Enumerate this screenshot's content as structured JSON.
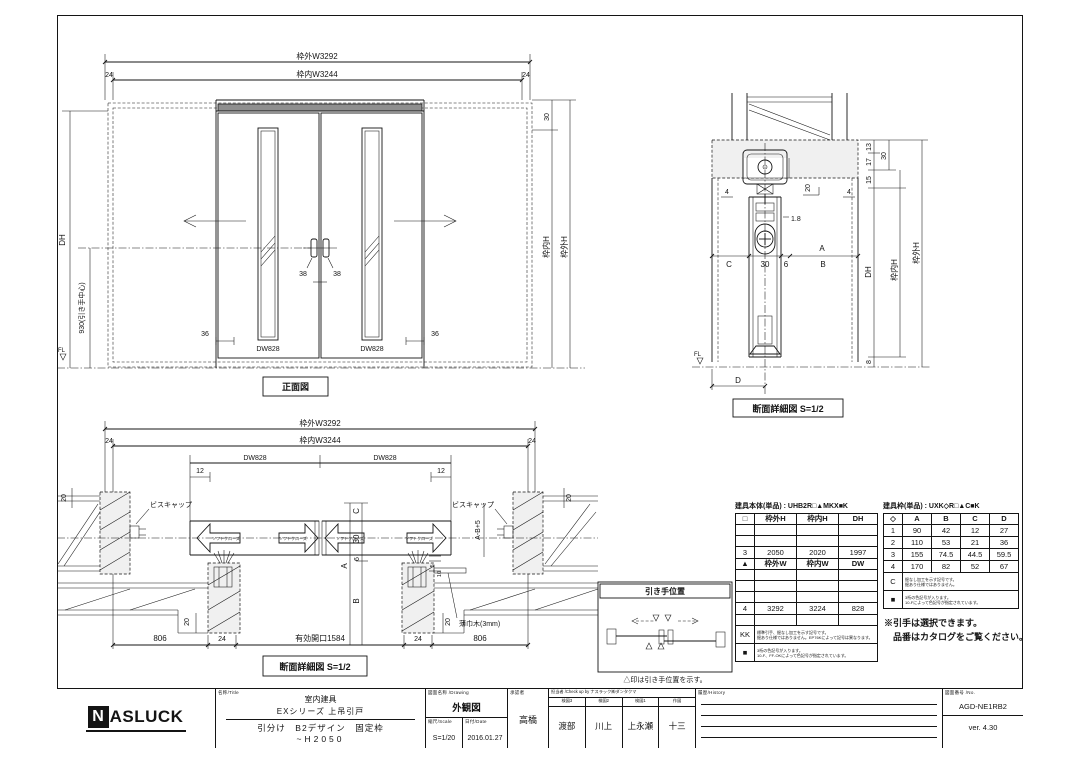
{
  "page": {
    "bg": "#ffffff",
    "ink": "#141414"
  },
  "front": {
    "title": "正面図",
    "outer_w": "枠外W3292",
    "inner_w": "枠内W3244",
    "m24l": "24",
    "m24r": "24",
    "m30": "30",
    "dh": "DH",
    "handle_h": "930(引き手中心)",
    "inner_h": "枠内H",
    "outer_h": "枠外H",
    "m36l": "36",
    "m36r": "36",
    "m38l": "38",
    "m38r": "38",
    "dwl": "DW828",
    "dwr": "DW828",
    "fl": "FL"
  },
  "secv": {
    "title": "断面詳細図 S=1/2",
    "m13": "13",
    "m17": "17",
    "m15": "15",
    "m30top": "30",
    "m20": "20",
    "m4l": "4",
    "m4r": "4",
    "m18": "1.8",
    "mA": "A",
    "mC": "C",
    "m30": "30",
    "m6": "6",
    "mB": "B",
    "dh": "DH",
    "inner_h": "枠内H",
    "outer_h": "枠外H",
    "m8": "8",
    "mD": "D",
    "fl": "FL"
  },
  "sech": {
    "title": "断面詳細図 S=1/2",
    "outer_w": "枠外W3292",
    "inner_w": "枠内W3244",
    "m24l": "24",
    "m24r": "24",
    "dwl": "DW828",
    "dwr": "DW828",
    "m12l": "12",
    "m12r": "12",
    "m20tl": "20",
    "m20tr": "20",
    "m20bl": "20",
    "m20br": "20",
    "screwl": "ビスキャップ",
    "screwr": "ビスキャップ",
    "soft": "ソフトクローズ",
    "mC": "C",
    "m30": "30",
    "m6": "6",
    "mA": "A",
    "mB": "B",
    "m5": "5",
    "m10": "10",
    "mab": "A-B+5",
    "skirt": "薄巾木(3mm)",
    "m806l": "806",
    "m24bl": "24",
    "opening": "有効開口1584",
    "m24br": "24",
    "m806r": "806"
  },
  "hpos": {
    "title": "引き手位置",
    "caption": "△印は引き手位置を示す。"
  },
  "tleft": {
    "title": "建具本体(単品) : UHB2R□▲MKX■K",
    "h1": [
      "□",
      "枠外H",
      "枠内H",
      "DH"
    ],
    "r3": [
      "3",
      "2050",
      "2020",
      "1997"
    ],
    "h2": [
      "▲",
      "枠外W",
      "枠内W",
      "DW"
    ],
    "r4": [
      "4",
      "3292",
      "3224",
      "828"
    ],
    "kk": "KK",
    "kk1": "標準引手、掘なし加工を示す記号です。",
    "kk2": "掘あり仕様ではありません。EP76Kによって記号は異なります。",
    "sq": "■",
    "sq1": "3桁の色記号が入ります。",
    "sq2": "10-F、FF-OKによって色記号が指定されています。"
  },
  "tright": {
    "title": "建具枠(単品) : UXK◇R□▲C■K",
    "h": [
      "◇",
      "A",
      "B",
      "C",
      "D"
    ],
    "r1": [
      "1",
      "90",
      "42",
      "12",
      "27"
    ],
    "r2": [
      "2",
      "110",
      "53",
      "21",
      "36"
    ],
    "r3": [
      "3",
      "155",
      "74.5",
      "44.5",
      "59.5"
    ],
    "r4": [
      "4",
      "170",
      "82",
      "52",
      "67"
    ],
    "ck": "C",
    "c1": "掘なし加工を示す記号です。",
    "c2": "掘あり仕様ではありません。",
    "sq": "■",
    "sq1": "3桁の色記号が入ります。",
    "sq2": "10-Fによって色記号が指定されています。"
  },
  "notes": {
    "n1": "※引手は選択できます。",
    "n2": "品番はカタログをご覧ください。"
  },
  "tb": {
    "logo_n": "N",
    "logo": "ASLUCK",
    "name_label": "名称/Title",
    "name1": "室内建具",
    "name2": "EXシリーズ 上吊引戸",
    "name3": "引分け　B2デザイン　固定枠",
    "name4": "~H2050",
    "drw_label": "図面名称 /Drawing",
    "drw": "外観図",
    "scale_label": "縮尺/Scale",
    "scale": "S=1/20",
    "date_label": "日付/Date",
    "date": "2016.01.27",
    "appr_label": "承認者",
    "appr": "高橋",
    "check_label": "担当者 /Check up by ナスラック㈱ダンタクマ",
    "c1l": "検図3",
    "c1": "渡部",
    "c2l": "検図2",
    "c2": "川上",
    "c3l": "検図1",
    "c3": "上永瀬",
    "c4l": "作図",
    "c4": "十三",
    "hist_label": "履歴/History",
    "no_label": "図面番号 /No.",
    "no": "AGD-NE1RB2",
    "ver": "ver. 4.30"
  }
}
